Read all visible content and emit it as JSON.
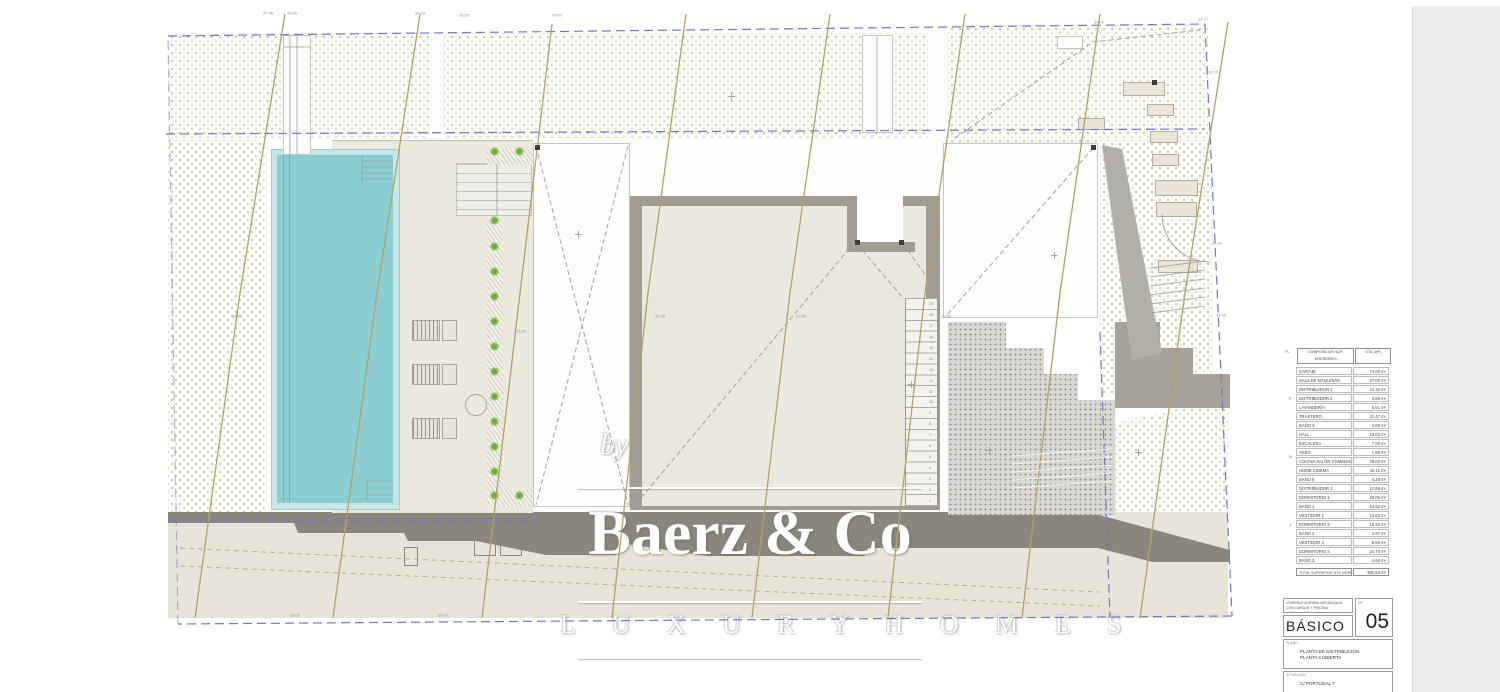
{
  "watermark": {
    "by": "by",
    "brand": "Baerz & Co",
    "tagline": "L U X U R Y   H O M E S"
  },
  "area_table": {
    "header": {
      "col_floor": "PL.",
      "col_name": "COMPOSICIÓN SUP. INTERIORES",
      "col_value": "ÚTIL (m²)"
    },
    "groups": [
      {
        "label": "P",
        "rows": [
          {
            "name": "GARAJE",
            "value": "74.00 m²"
          },
          {
            "name": "SALA DE MÁQUINAS",
            "value": "27.00 m²"
          },
          {
            "name": "DISTRIBUIDOR 1",
            "value": "12.32 m²"
          },
          {
            "name": "DISTRIBUIDOR 2",
            "value": "3.88 m²"
          },
          {
            "name": "LAVANDERÍA",
            "value": "6.51 m²"
          },
          {
            "name": "TRASTERO",
            "value": "11.47 m²"
          },
          {
            "name": "BAÑO 4",
            "value": "4.88 m²"
          }
        ]
      },
      {
        "label": "B",
        "rows": [
          {
            "name": "HALL",
            "value": "13.03 m²"
          },
          {
            "name": "ESCALERA",
            "value": "7.00 m²"
          },
          {
            "name": "ASEO",
            "value": "1.86 m²"
          },
          {
            "name": "COCINA SALÓN COMEDOR",
            "value": "78.03 m²"
          },
          {
            "name": "HOME CINEMA",
            "value": "18.11 m²"
          },
          {
            "name": "BAÑO 5",
            "value": "4.28 m²"
          }
        ]
      },
      {
        "label": "1",
        "rows": [
          {
            "name": "DISTRIBUIDOR 3",
            "value": "12.69 m²"
          },
          {
            "name": "DORMITORIO 1",
            "value": "20.06 m²"
          },
          {
            "name": "BAÑO 1",
            "value": "14.62 m²"
          },
          {
            "name": "VESTIDOR 1",
            "value": "12.63 m²"
          },
          {
            "name": "DORMITORIO 2",
            "value": "16.25 m²"
          },
          {
            "name": "BAÑO 2",
            "value": "4.97 m²"
          },
          {
            "name": "VESTIDOR 2",
            "value": "6.50 m²"
          },
          {
            "name": "DORMITORIO 3",
            "value": "24.70 m²"
          },
          {
            "name": "BAÑO 3",
            "value": "4.68 m²"
          }
        ]
      }
    ],
    "total": {
      "label": "TOTAL SUPERFICIE ÚTIL INTERIOR",
      "value": "381.54 m²"
    }
  },
  "title_block": {
    "project_line1": "VIVIENDA UNIFAMILIAR AISLADA",
    "project_line2": "CON GARAJE Y PISCINA",
    "number_label": "Nº",
    "phase": "BÁSICO",
    "sheet_number": "05",
    "plan_label": "PLANO",
    "plan_line1": "PLANTA DE DISTRIBUCIÓN",
    "plan_line2": "PLANTA CUBIERTA",
    "location_label": "SITUACIÓN",
    "location_value": "C/ PORTUGAL 7"
  },
  "plan_labels": [
    {
      "text": "27.98",
      "x": 268,
      "y": 13
    },
    {
      "text": "28.00",
      "x": 292,
      "y": 13
    },
    {
      "text": "28.03",
      "x": 420,
      "y": 13
    },
    {
      "text": "28.50",
      "x": 464,
      "y": 15
    },
    {
      "text": "29.00",
      "x": 557,
      "y": 15
    },
    {
      "text": "34.00",
      "x": 1099,
      "y": 22
    },
    {
      "text": "34.77",
      "x": 1203,
      "y": 19
    },
    {
      "text": "34.79",
      "x": 1213,
      "y": 72
    },
    {
      "text": "34.90",
      "x": 1217,
      "y": 243
    },
    {
      "text": "34.88",
      "x": 1221,
      "y": 315
    },
    {
      "text": "30.58",
      "x": 237,
      "y": 316
    },
    {
      "text": "32.00",
      "x": 521,
      "y": 331
    },
    {
      "text": "31.06",
      "x": 660,
      "y": 316
    },
    {
      "text": "32.00",
      "x": 801,
      "y": 316
    },
    {
      "text": "32.00",
      "x": 946,
      "y": 316
    },
    {
      "text": "29.00",
      "x": 295,
      "y": 615
    },
    {
      "text": "30.00",
      "x": 443,
      "y": 615
    }
  ],
  "stair_numbers": [
    "19",
    "18",
    "17",
    "16",
    "15",
    "14",
    "13",
    "12",
    "11",
    "10",
    "9",
    "8",
    "7",
    "6",
    "5",
    "4",
    "3",
    "2",
    "1"
  ]
}
